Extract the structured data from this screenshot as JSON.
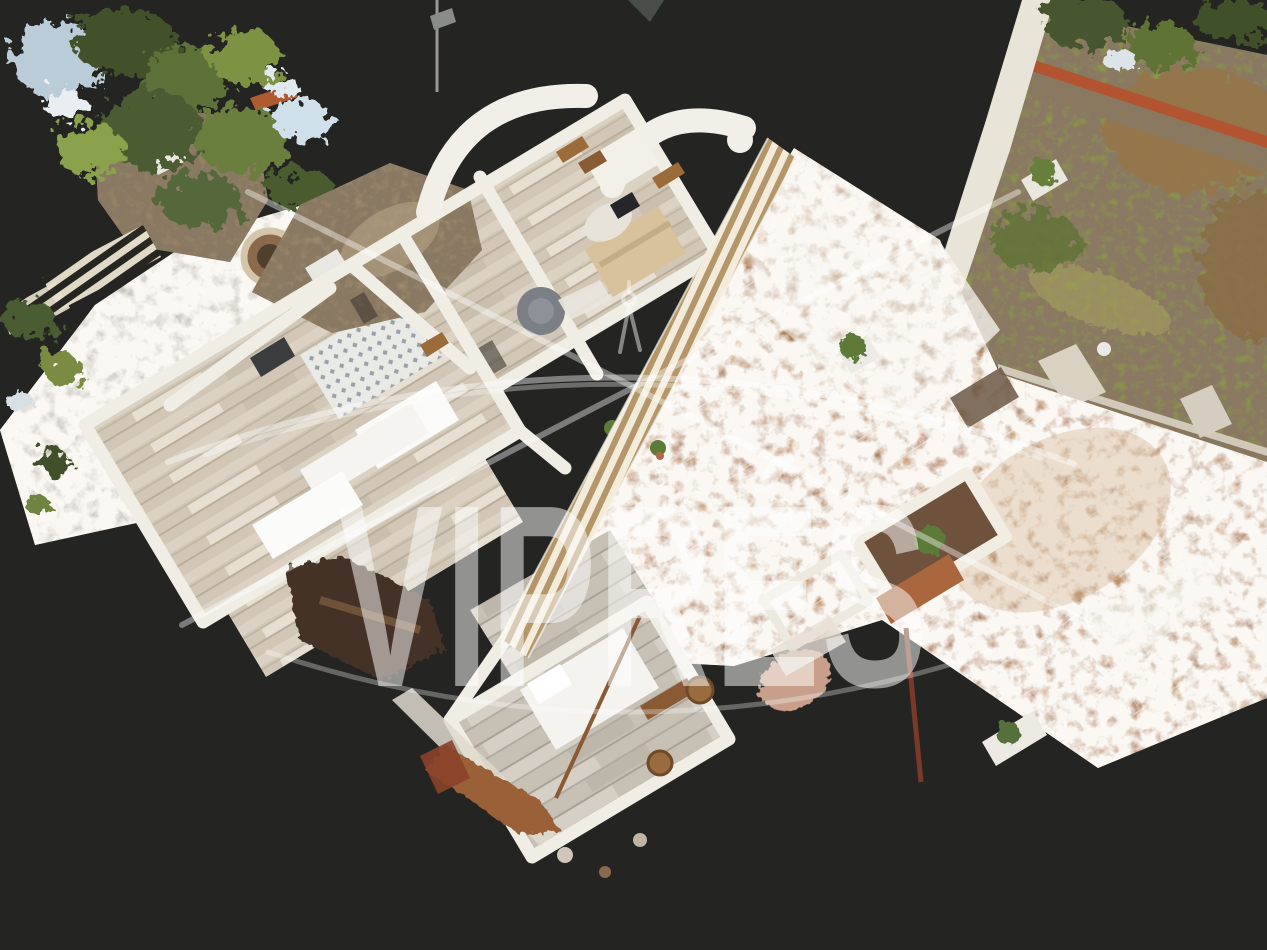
{
  "view": {
    "type": "3D dollhouse property scan viewer",
    "background_color": "#242423",
    "watermark_opacity": "0.5"
  },
  "watermark": {
    "text": "VIPRÉS",
    "color": "#ffffff",
    "logo_icon": "vaulted-arches-logo-icon"
  },
  "palette": {
    "wood_floor": "#d2c7b6",
    "grey_wood_floor": "#c7c0b5",
    "white_wall": "#f0ede5",
    "rustic_stone": "#9d8b6f",
    "terracotta_tile": "#bf9068",
    "garden_grass": "#8b9648",
    "brick_coping": "#b35430"
  }
}
